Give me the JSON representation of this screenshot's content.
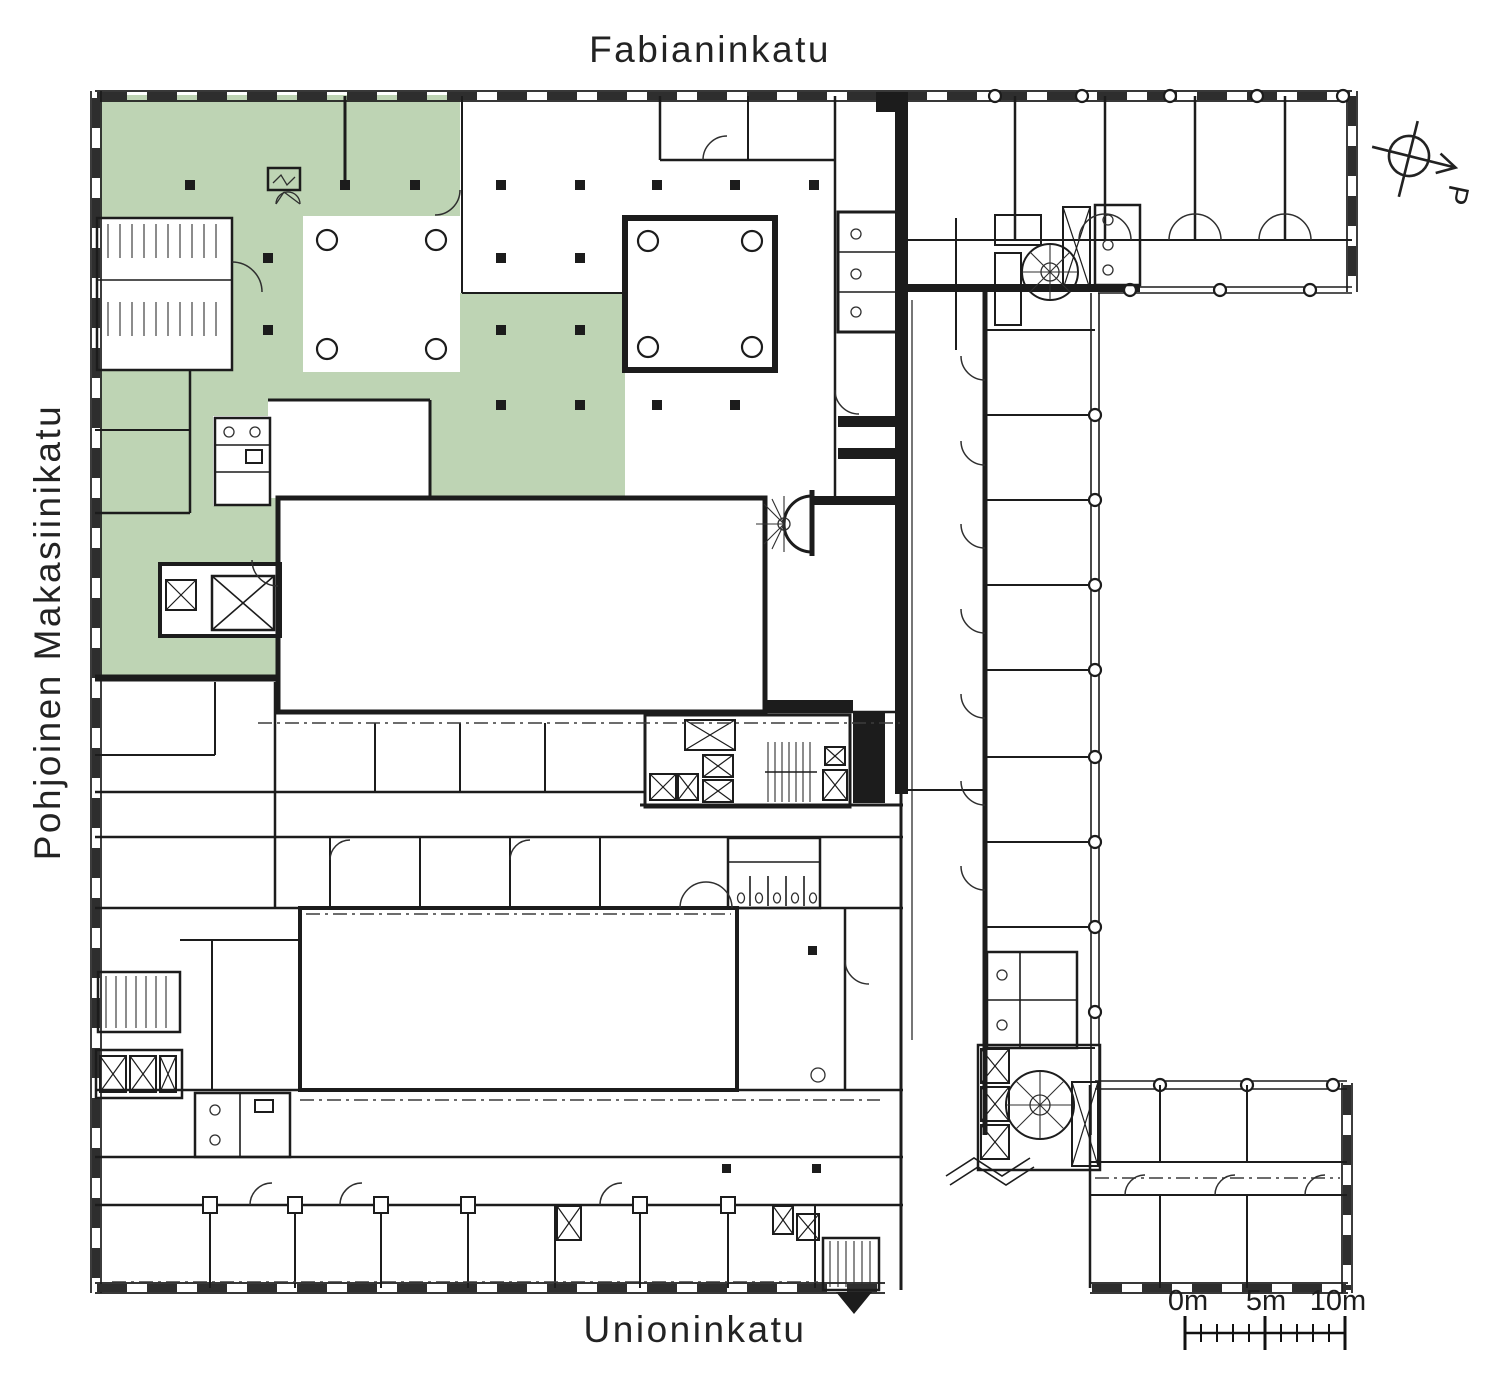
{
  "plan": {
    "streets": {
      "top": "Fabianinkatu",
      "left": "Pohjoinen Makasiinikatu",
      "bottom": "Unioninkatu"
    },
    "compass": {
      "label": "P",
      "icon": "north-arrow-icon"
    },
    "scale_bar": {
      "icon": "scale-bar",
      "labels": [
        "0m",
        "5m",
        "10m"
      ]
    },
    "colors": {
      "highlight": "#bed4b4",
      "wall": "#1c1c1c",
      "background": "#ffffff"
    }
  }
}
